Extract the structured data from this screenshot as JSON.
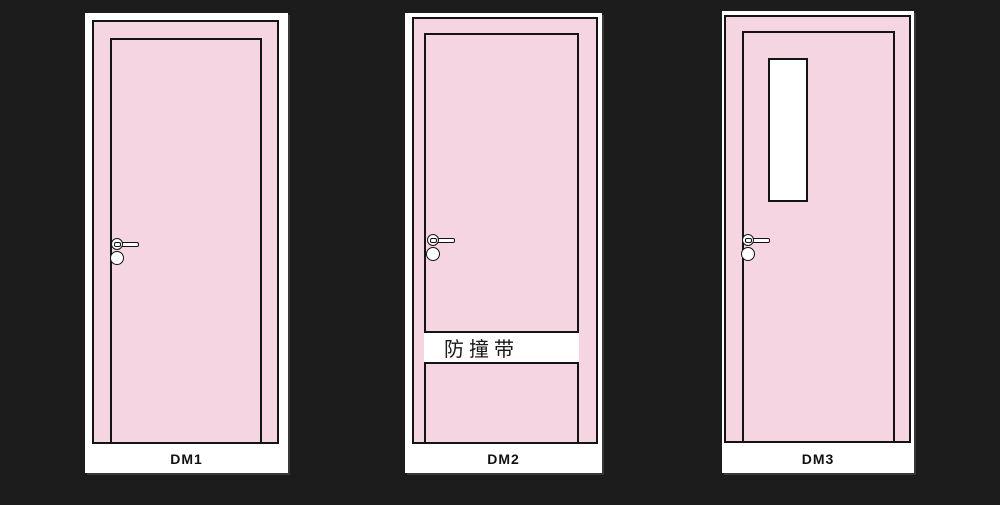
{
  "canvas": {
    "background": "#1c1c1c",
    "door_fill": "#f6d5e3",
    "line_color": "#141414",
    "panel_color": "#ffffff"
  },
  "doors": [
    {
      "label": "DM1"
    },
    {
      "label": "DM2",
      "band_text": "防撞带"
    },
    {
      "label": "DM3"
    }
  ]
}
